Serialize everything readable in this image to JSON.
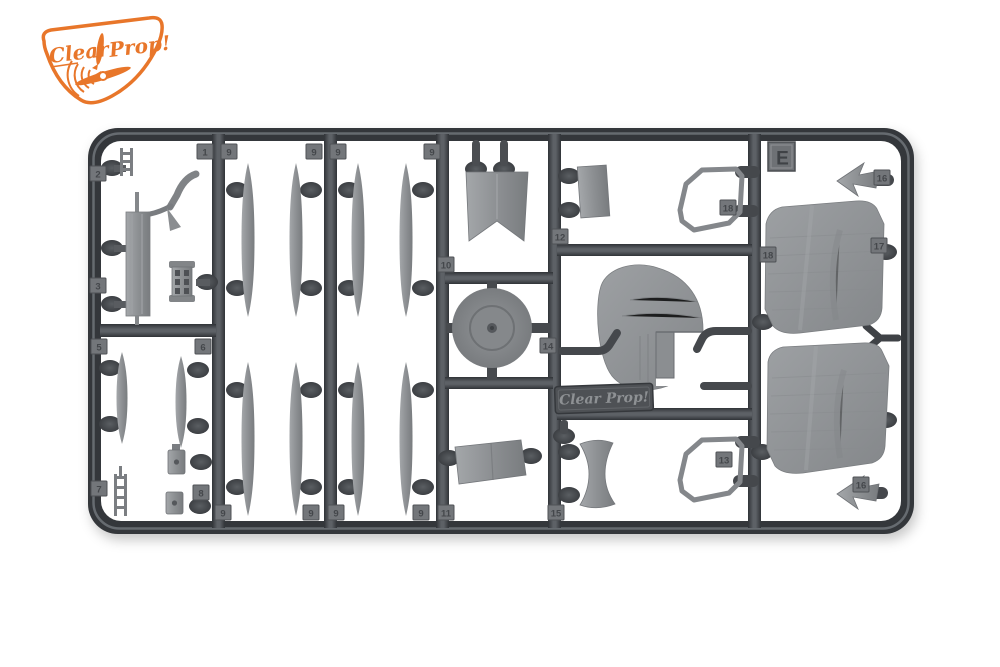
{
  "scene": {
    "type": "product photo of a plastic model kit sprue on white background"
  },
  "logo": {
    "word1": "Clear",
    "word2": "Prop!",
    "color": "#e8762a"
  },
  "sprue": {
    "letter": "E",
    "nameplate_text": "Clear Prop!",
    "colors": {
      "runner_dark": "#34373b",
      "runner_mid": "#5d6166",
      "part_gray": "#8d9093",
      "wing_gray": "#94979a",
      "tab_gray": "#73767a"
    },
    "tags": [
      "2",
      "3",
      "5",
      "7",
      "6",
      "8",
      "1",
      "9",
      "9",
      "9",
      "9",
      "9",
      "9",
      "9",
      "9",
      "11",
      "15",
      "10",
      "12",
      "14",
      "18",
      "18",
      "13",
      "16",
      "17",
      "16"
    ]
  }
}
